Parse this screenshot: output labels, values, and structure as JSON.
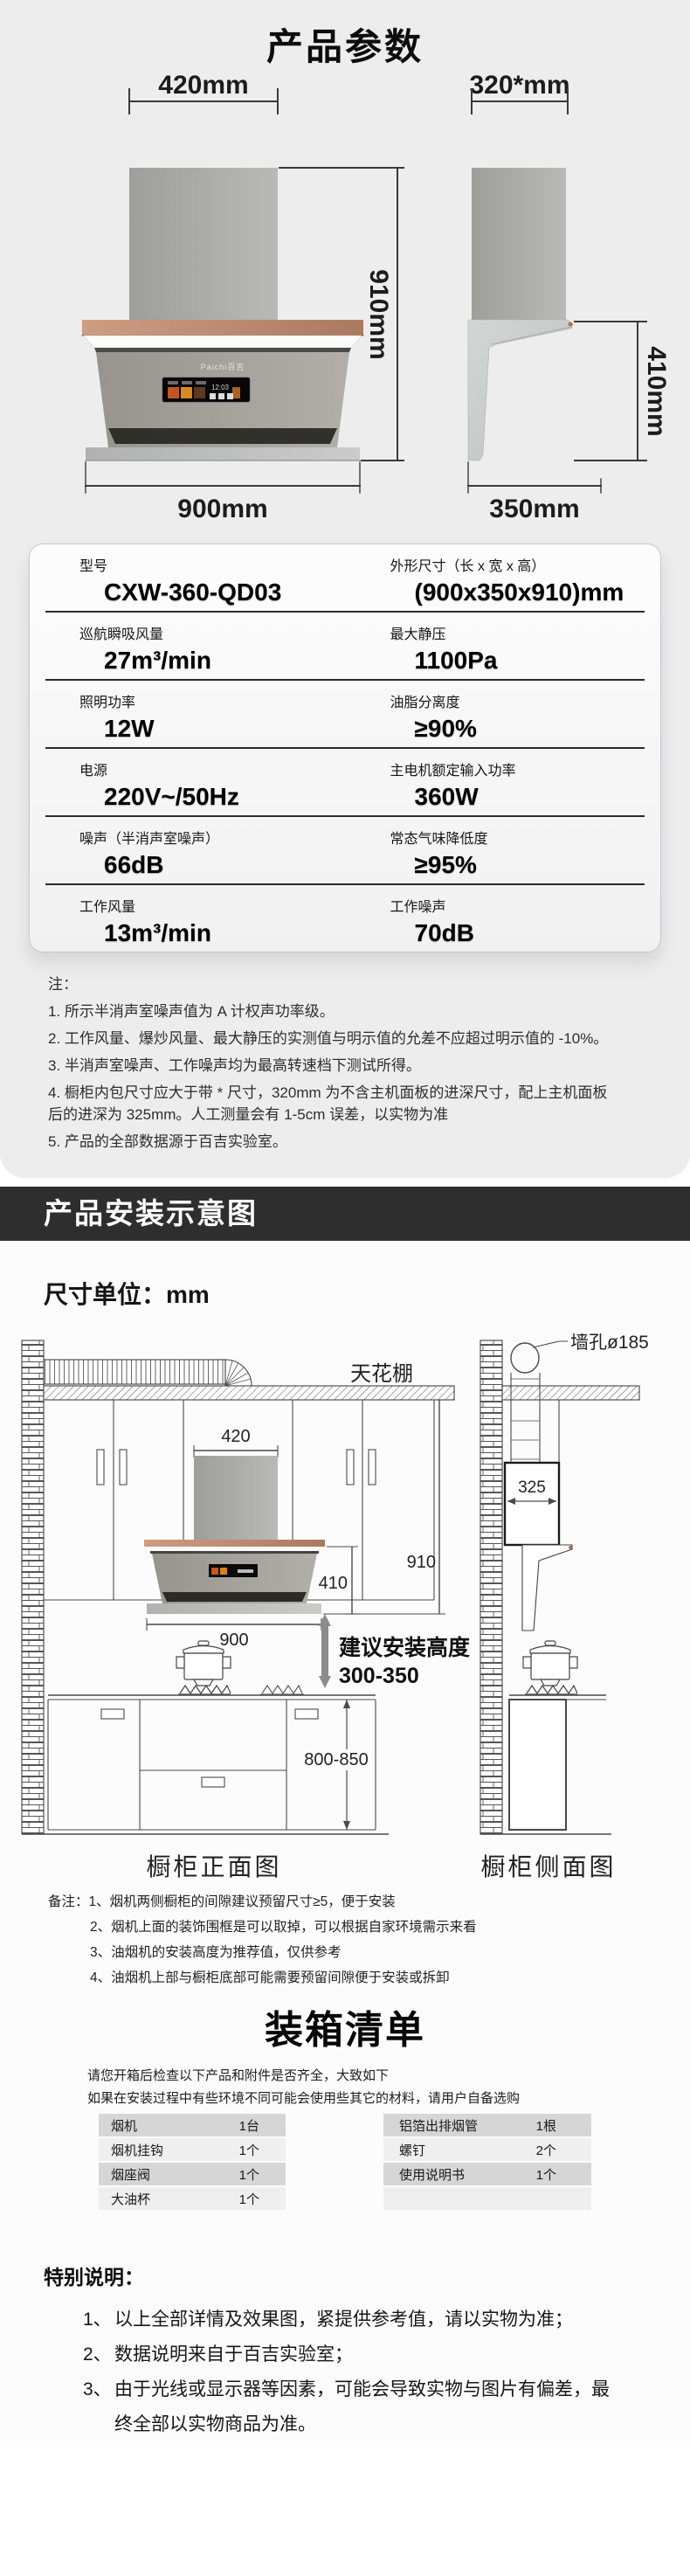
{
  "page": {
    "title": "产品参数"
  },
  "colors": {
    "panel_bg": "#ededee",
    "banner_bg": "#2e2e2e",
    "copper_accent": "#c06a45",
    "table_row_dark": "#d6d6d6",
    "table_row_light": "#efefef"
  },
  "dim_diagram": {
    "front": {
      "top_width": "420mm",
      "total_height": "910mm",
      "bottom_width": "900mm",
      "brand": "Paichi百吉",
      "screen_time": "12:03"
    },
    "side": {
      "top_depth": "320*mm",
      "bottom_depth": "350mm",
      "body_height": "410mm"
    }
  },
  "specs": {
    "rows": [
      {
        "l_label": "型号",
        "l_value": "CXW-360-QD03",
        "r_label": "外形尺寸（长 x 宽 x 高）",
        "r_value": "(900x350x910)mm"
      },
      {
        "l_label": "巡航瞬吸风量",
        "l_value": "27m³/min",
        "r_label": "最大静压",
        "r_value": "1100Pa"
      },
      {
        "l_label": "照明功率",
        "l_value": "12W",
        "r_label": "油脂分离度",
        "r_value": "≥90%"
      },
      {
        "l_label": "电源",
        "l_value": "220V~/50Hz",
        "r_label": "主电机额定输入功率",
        "r_value": "360W"
      },
      {
        "l_label": "噪声（半消声室噪声）",
        "l_value": "66dB",
        "r_label": "常态气味降低度",
        "r_value": "≥95%"
      },
      {
        "l_label": "工作风量",
        "l_value": "13m³/min",
        "r_label": "工作噪声",
        "r_value": "70dB"
      }
    ]
  },
  "notes": {
    "heading": "注：",
    "items": [
      "1. 所示半消声室噪声值为 A 计权声功率级。",
      "2. 工作风量、爆炒风量、最大静压的实测值与明示值的允差不应超过明示值的 -10%。",
      "3. 半消声室噪声、工作噪声均为最高转速档下测试所得。",
      "4. 橱柜内包尺寸应大于带 * 尺寸，320mm 为不含主机面板的进深尺寸，配上主机面板后的进深为 325mm。人工测量会有 1-5cm 误差，以实物为准",
      "5. 产品的全部数据源于百吉实验室。"
    ]
  },
  "banner": {
    "title": "产品安装示意图"
  },
  "install": {
    "unit_label": "尺寸单位：mm",
    "labels": {
      "ceiling": "天花棚",
      "wall_hole": "墙孔ø185",
      "suggest_line1": "建议安装高度",
      "suggest_line2": "300-350",
      "front_view": "橱柜正面图",
      "side_view": "橱柜侧面图"
    },
    "dims": {
      "w420": "420",
      "h910": "910",
      "h410": "410",
      "w900": "900",
      "h800": "800-850",
      "d325": "325"
    },
    "remarks": {
      "items": [
        "备注：1、烟机两侧橱柜的间隙建议预留尺寸≥5，便于安装",
        "2、烟机上面的装饰围框是可以取掉，可以根据自家环境需示来看",
        "3、油烟机的安装高度为推荐值，仅供参考",
        "4、油烟机上部与橱柜底部可能需要预留间隙便于安装或拆卸"
      ]
    }
  },
  "packing": {
    "title": "装箱清单",
    "intro": [
      "请您开箱后检查以下产品和附件是否齐全，大致如下",
      "如果在安装过程中有些环境不同可能会使用些其它的材料，请用户自备选购"
    ],
    "left_rows": [
      {
        "name": "烟机",
        "qty": "1台"
      },
      {
        "name": "烟机挂钩",
        "qty": "1个"
      },
      {
        "name": "烟座阀",
        "qty": "1个"
      },
      {
        "name": "大油杯",
        "qty": "1个"
      }
    ],
    "right_rows": [
      {
        "name": "铝箔出排烟管",
        "qty": "1根"
      },
      {
        "name": "螺钉",
        "qty": "2个"
      },
      {
        "name": "使用说明书",
        "qty": "1个"
      },
      {
        "name": "",
        "qty": ""
      }
    ]
  },
  "special": {
    "heading": "特别说明：",
    "items": [
      {
        "num": "1、",
        "text": "以上全部详情及效果图，紧提供参考值，请以实物为准；"
      },
      {
        "num": "2、",
        "text": "数据说明来自于百吉实验室；"
      },
      {
        "num": "3、",
        "text": "由于光线或显示器等因素，可能会导致实物与图片有偏差，最终全部以实物商品为准。"
      }
    ]
  }
}
